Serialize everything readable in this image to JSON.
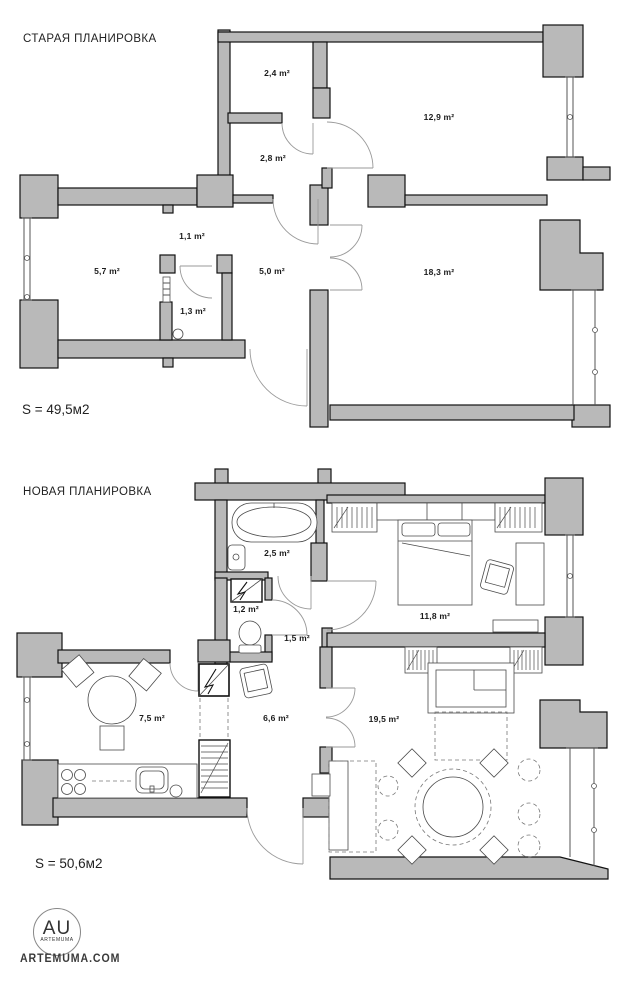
{
  "old_plan": {
    "title": "СТАРАЯ ПЛАНИРОВКА",
    "area_label": "S = 49,5м2",
    "rooms": {
      "storage": "2,4 m²",
      "bedroom": "12,9 m²",
      "hall": "2,8 m²",
      "corridor": "1,1 m²",
      "kitchen": "5,7 m²",
      "entry": "5,0 m²",
      "wc": "1,3 m²",
      "living": "18,3 m²"
    }
  },
  "new_plan": {
    "title": "НОВАЯ ПЛАНИРОВКА",
    "area_label": "S = 50,6м2",
    "rooms": {
      "bathroom": "2,5 m²",
      "laundry": "1,2 m²",
      "hallway_small": "1,5 m²",
      "bedroom": "11,8 m²",
      "kitchen": "7,5 m²",
      "hallway": "6,6 m²",
      "living": "19,5 m²"
    }
  },
  "footer": {
    "logo_initials": "AU",
    "logo_name": "ARTEMUMA",
    "website": "ARTEMUMA.COM"
  },
  "colors": {
    "wall_fill": "#b9b9b9",
    "outline": "#111111"
  }
}
